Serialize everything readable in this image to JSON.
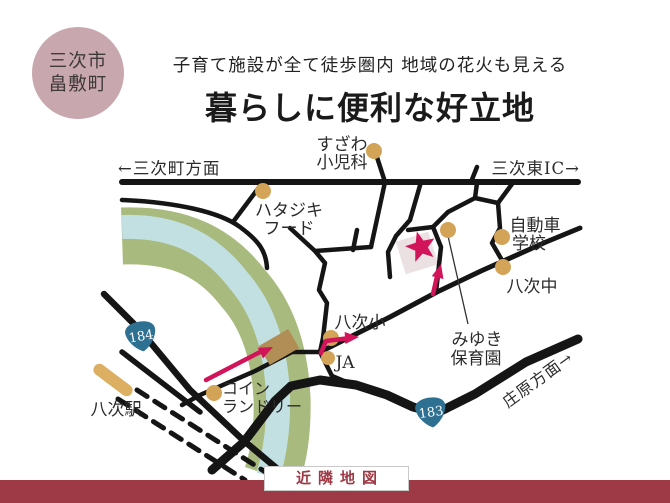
{
  "area_badge": {
    "line1": "三次市",
    "line2": "畠敷町"
  },
  "header": {
    "subtitle": "子育て施設が全て徒歩圏内 地域の花火も見える",
    "title": "暮らしに便利な好立地"
  },
  "footer": {
    "label": "近隣地図"
  },
  "map": {
    "directions": {
      "west": "←三次町方面",
      "east": "三次東IC→",
      "southeast": "庄原方面→"
    },
    "shields": [
      {
        "number": "184"
      },
      {
        "number": "183"
      }
    ],
    "pois": {
      "suzawa": {
        "line1": "すざわ",
        "line2": "小児科"
      },
      "hatajiki": {
        "line1": "ハタジキ",
        "line2": "フード"
      },
      "jidosha": {
        "line1": "自動車",
        "line2": "学校"
      },
      "yatsugi_chu": {
        "label": "八次中"
      },
      "miyuki": {
        "line1": "みゆき",
        "line2": "保育園"
      },
      "yatsugi_sho": {
        "label": "八次小"
      },
      "ja": {
        "label": "JA"
      },
      "coin_laundry": {
        "line1": "コイン",
        "line2": "ランドリー"
      },
      "station": {
        "label": "八次駅"
      }
    },
    "colors": {
      "road": "#151515",
      "river_bank": "#a9ba7e",
      "river_water": "#c2e0e2",
      "poi_dot": "#d3a458",
      "route_accent": "#d2145a",
      "shield_blue": "#2e7092",
      "badge_pink": "#c9a7af",
      "footer_maroon": "#9d3a46",
      "parcel": "#ebe0e2",
      "bridge_brown": "#b18e55",
      "platform_tan": "#dcaf62"
    }
  }
}
